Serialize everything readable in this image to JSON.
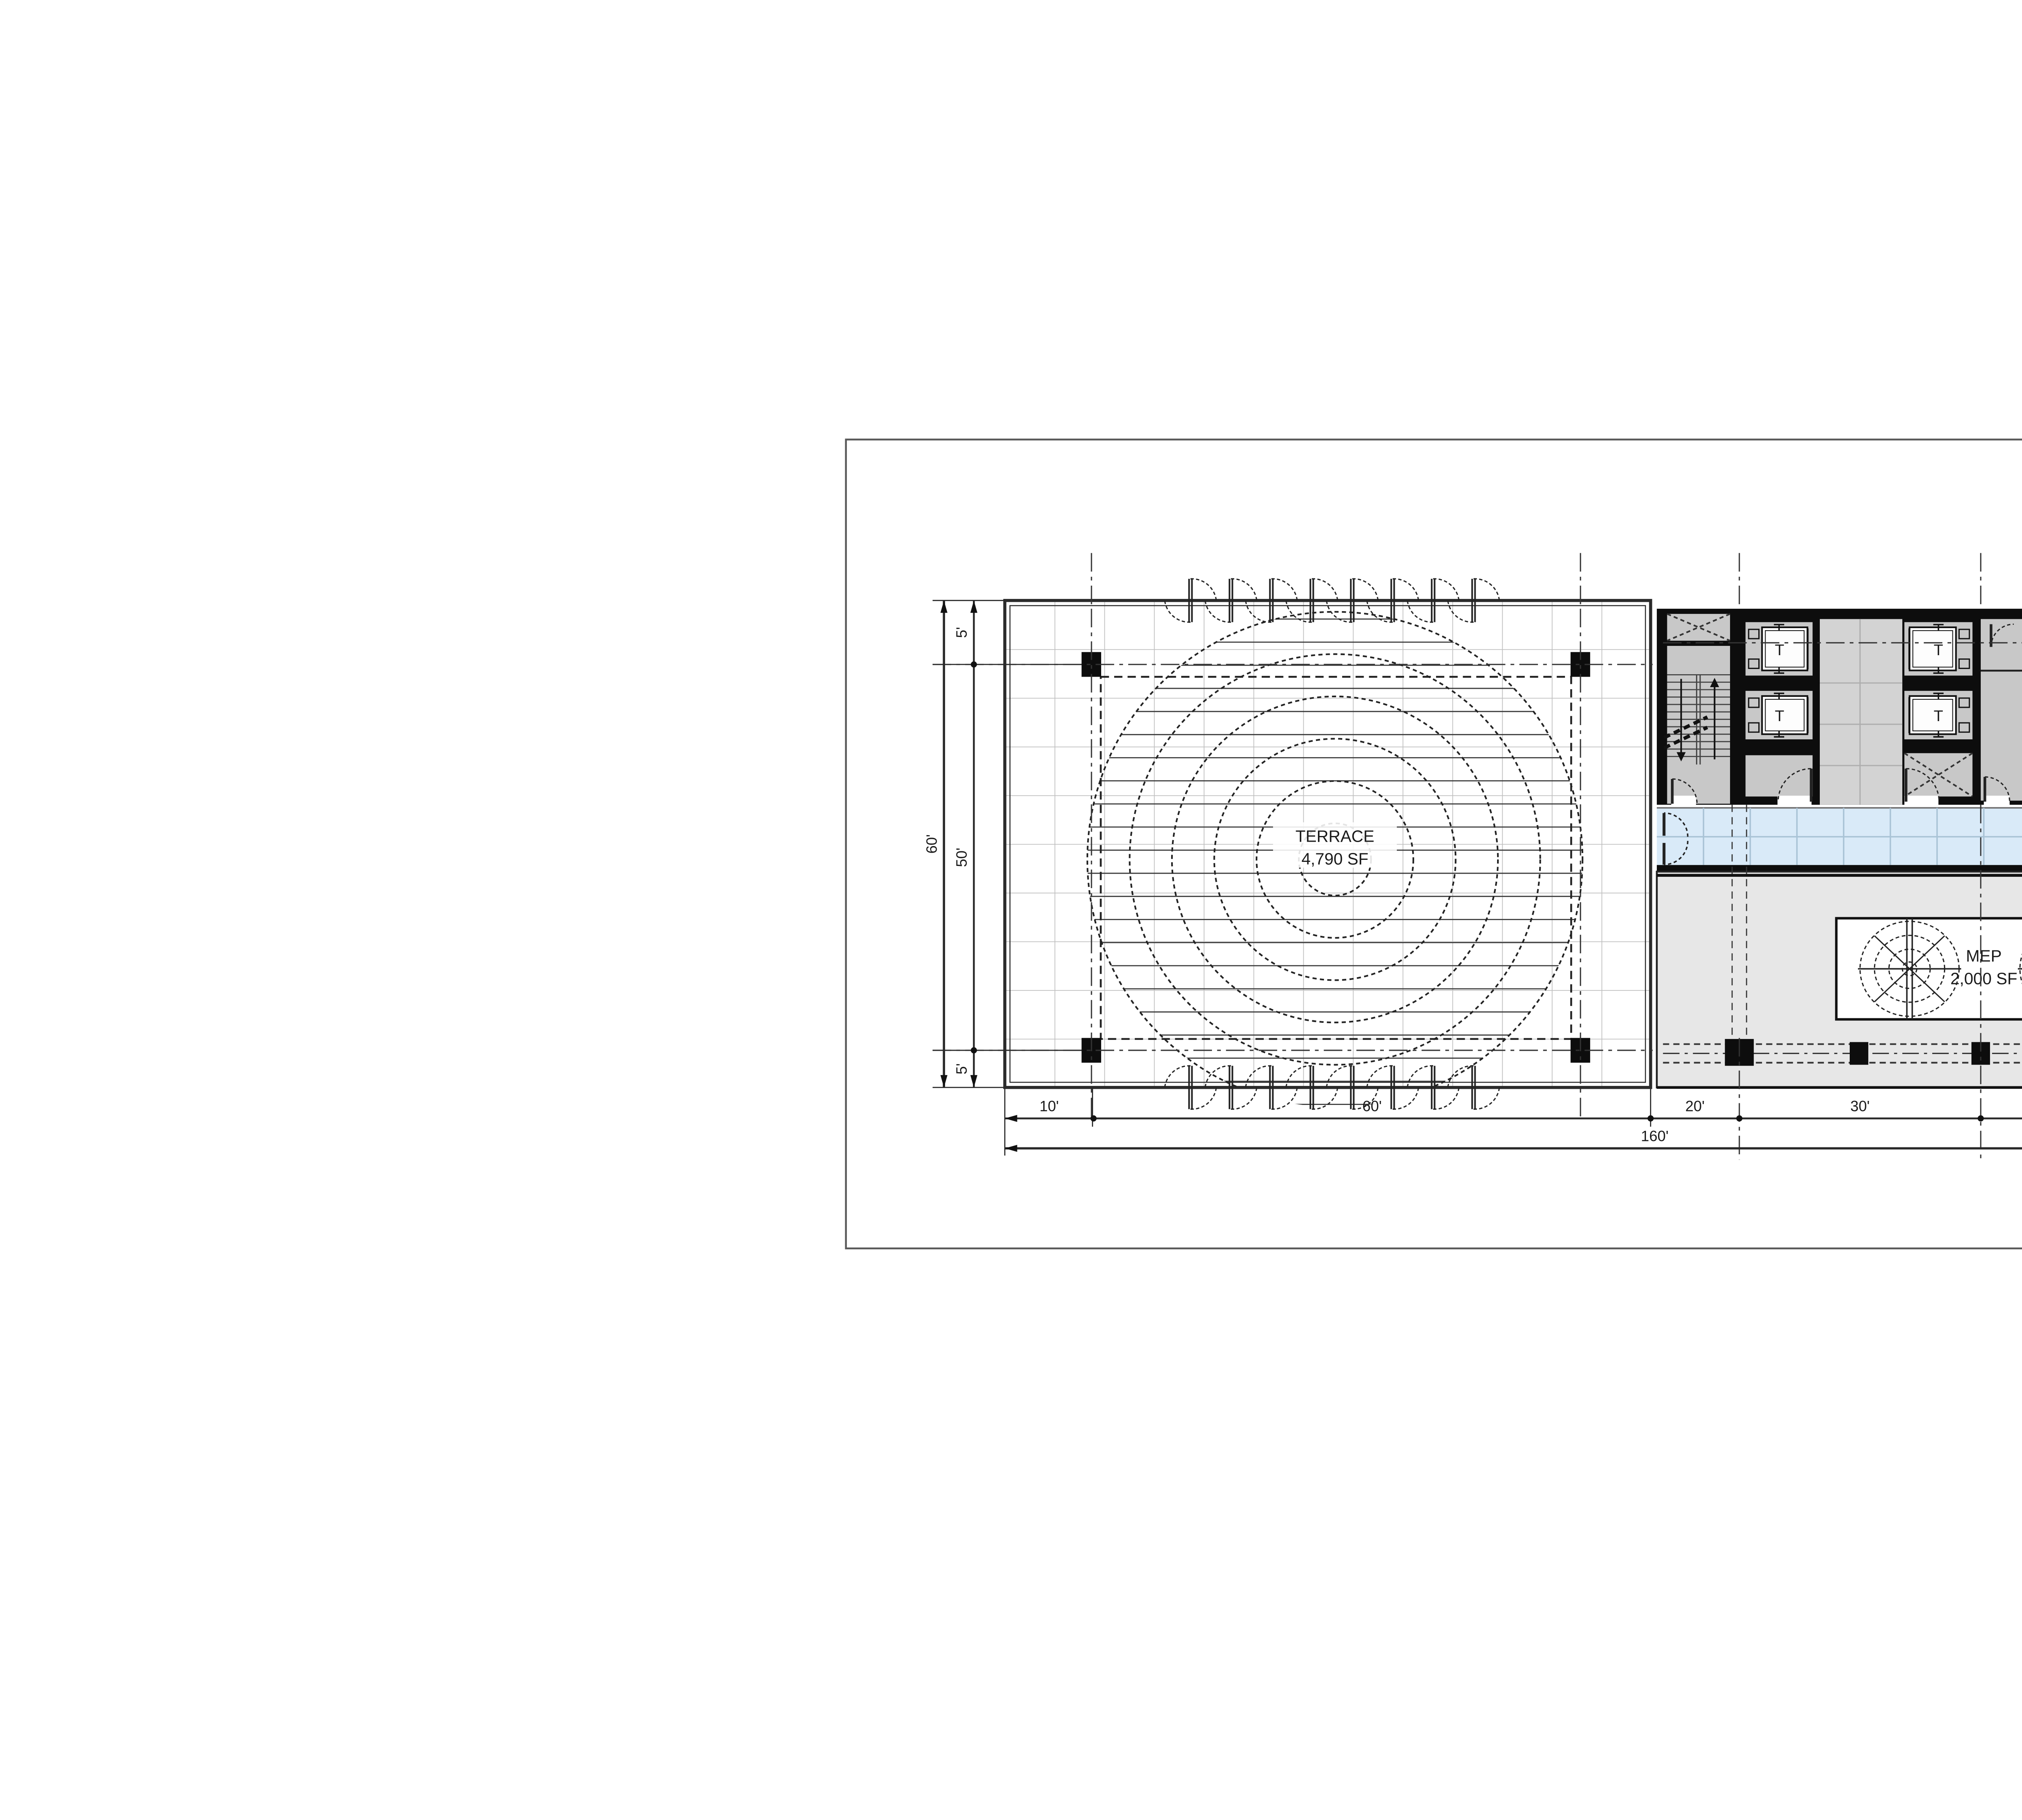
{
  "plan": {
    "terrace": {
      "name": "TERRACE",
      "area": "4,790 SF"
    },
    "mep": {
      "name": "MEP",
      "area": "2,000 SF"
    },
    "core": {
      "elevator_label": "T"
    },
    "dimensions": {
      "bottom": [
        "10'",
        "60'",
        "20'",
        "30'",
        "30'",
        "10'"
      ],
      "bottom_total": "160'",
      "left": [
        "5'",
        "50'",
        "5'"
      ],
      "left_total": "60'"
    },
    "colors": {
      "wall": "#0d0d0d",
      "room_gray": "#c8c8c8",
      "lobby_gray": "#d3d3d3",
      "building_gray": "#e9e9e9",
      "mep_gray": "#e7e7e7",
      "corridor_blue": "#d9eaf8",
      "corridor_grid": "#a9c3d6",
      "line": "#222222"
    }
  }
}
